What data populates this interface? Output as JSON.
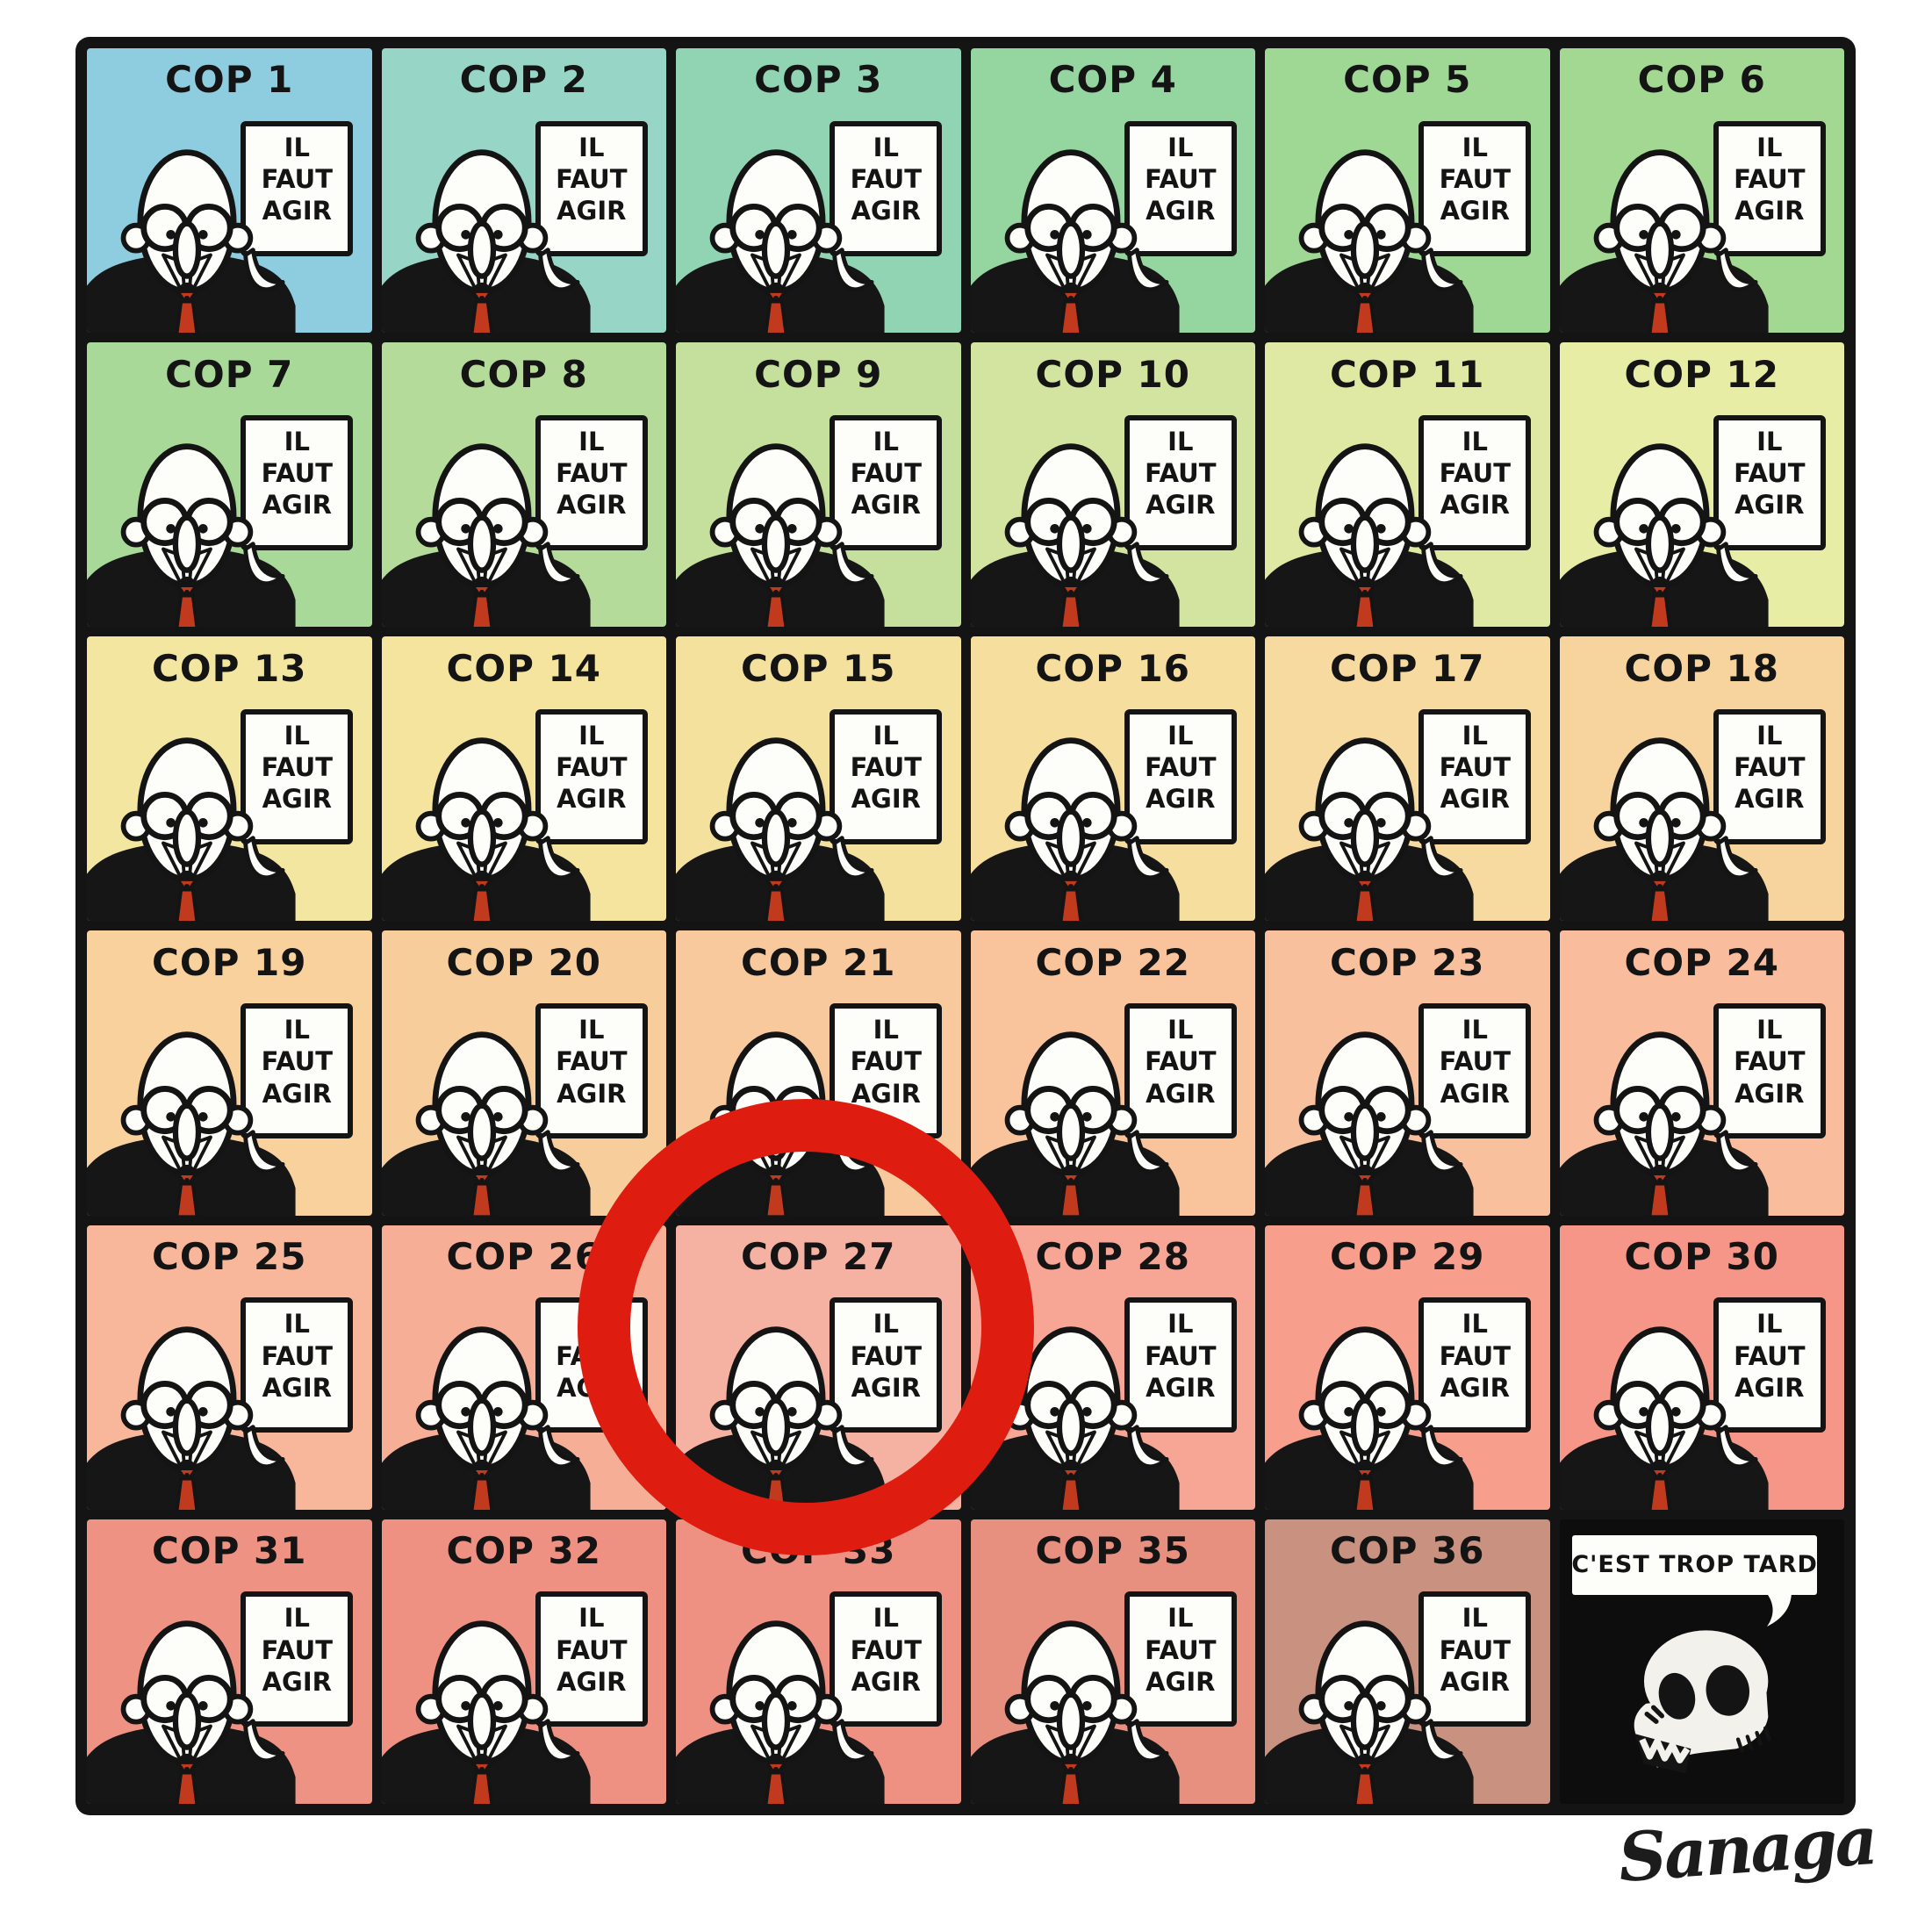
{
  "comic": {
    "bubble_text": "IL FAUT AGIR",
    "you_are_here": "VOUS ÊTES ICI",
    "too_late_text": "C'EST TROP TARD",
    "signature": "Sanaga",
    "colors": {
      "ring_red": "#de1d10",
      "tie_red": "#c23a1e",
      "ink_black": "#141414",
      "paper_white": "#fdfdfa"
    },
    "cells": [
      {
        "label": "COP 1",
        "bg": "#8ecde0"
      },
      {
        "label": "COP 2",
        "bg": "#97d5c6"
      },
      {
        "label": "COP 3",
        "bg": "#91d4b3"
      },
      {
        "label": "COP 4",
        "bg": "#95d6a0"
      },
      {
        "label": "COP 5",
        "bg": "#9fd795"
      },
      {
        "label": "COP 6",
        "bg": "#a3d892"
      },
      {
        "label": "COP 7",
        "bg": "#a9d998"
      },
      {
        "label": "COP 8",
        "bg": "#b5db9a"
      },
      {
        "label": "COP 9",
        "bg": "#c5df9d"
      },
      {
        "label": "COP 10",
        "bg": "#d3e4a1"
      },
      {
        "label": "COP 11",
        "bg": "#dfe9a3"
      },
      {
        "label": "COP 12",
        "bg": "#e7eda4"
      },
      {
        "label": "COP 13",
        "bg": "#f3e6a0"
      },
      {
        "label": "COP 14",
        "bg": "#f4e49d"
      },
      {
        "label": "COP 15",
        "bg": "#f5e19e"
      },
      {
        "label": "COP 16",
        "bg": "#f6de9e"
      },
      {
        "label": "COP 17",
        "bg": "#f7da9f"
      },
      {
        "label": "COP 18",
        "bg": "#f7d49d"
      },
      {
        "label": "COP 19",
        "bg": "#f8d19c"
      },
      {
        "label": "COP 20",
        "bg": "#f8cd9c"
      },
      {
        "label": "COP 21",
        "bg": "#f9c99e"
      },
      {
        "label": "COP 22",
        "bg": "#f9c49c"
      },
      {
        "label": "COP 23",
        "bg": "#f9c09d"
      },
      {
        "label": "COP 24",
        "bg": "#f9bc9c"
      },
      {
        "label": "COP 25",
        "bg": "#f8b79a"
      },
      {
        "label": "COP 26",
        "bg": "#f7ae97"
      },
      {
        "label": "COP 27",
        "bg": "#f5b2a3"
      },
      {
        "label": "COP 28",
        "bg": "#f7a695"
      },
      {
        "label": "COP 29",
        "bg": "#f79e8d"
      },
      {
        "label": "COP 30",
        "bg": "#f59688"
      },
      {
        "label": "COP 31",
        "bg": "#ee9383"
      },
      {
        "label": "COP 32",
        "bg": "#ee9182"
      },
      {
        "label": "COP 33",
        "bg": "#ee9082"
      },
      {
        "label": "COP 35",
        "bg": "#e89080"
      },
      {
        "label": "COP 36",
        "bg": "#c9917f"
      },
      {
        "label": "",
        "type": "final",
        "bg": "#0d0d0d"
      }
    ]
  }
}
